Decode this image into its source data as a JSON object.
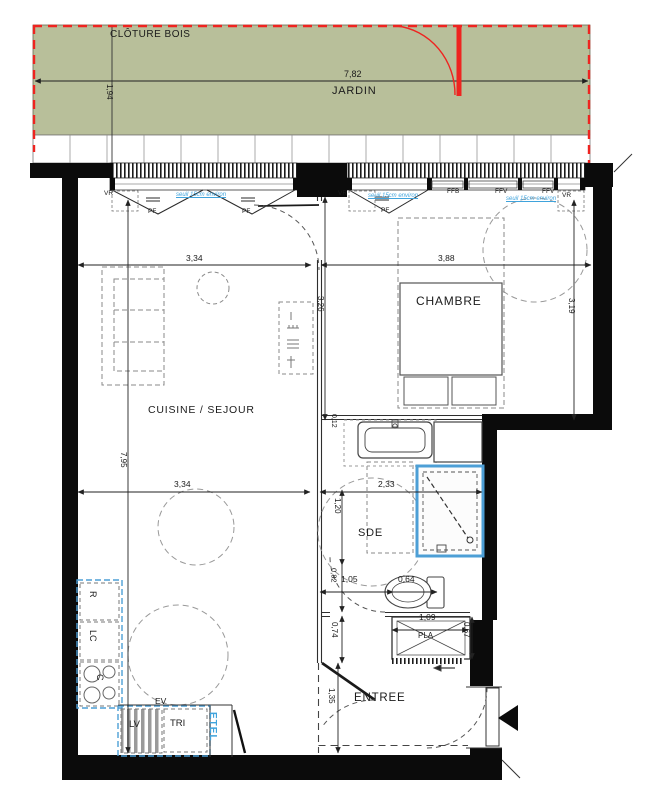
{
  "garden": {
    "fence": "CLÔTURE BOIS",
    "name": "JARDIN",
    "width": "7,82",
    "depth": "1,94"
  },
  "rooms": {
    "kitchen": "CUISINE / SEJOUR",
    "bedroom": "CHAMBRE",
    "bath": "SDE",
    "entry": "ENTREE",
    "closet": "PLA"
  },
  "dims": {
    "kitchen_w": "3,34",
    "bedroom_w": "3,88",
    "bedroom_h_left": "3,26",
    "bedroom_h_right": "3,19",
    "kitchen_h": "7,95",
    "kitchen_w2": "3,34",
    "bath_w": "2,33",
    "bath_h": "1,20",
    "wall_t": "0,12",
    "wc_l": "1,05",
    "wc_w": "0,64",
    "wc_h": "0,82",
    "pla_h_left": "0,74",
    "pla_w": "1,09",
    "pla_h_right": "0,67",
    "entry_h": "1,35"
  },
  "windows": {
    "vr": "VR",
    "pf": "PF",
    "ffb": "FFB",
    "ffv": "FFV",
    "seuil_note": "seuil 15cm environ"
  },
  "appliances": {
    "fridge": "R",
    "washer": "LC",
    "hob": "C",
    "dishwasher": "LV",
    "sorting": "TRI",
    "sink": "EV",
    "etel": "ETEL"
  },
  "colors": {
    "garden": "#b8bf9a",
    "fence": "#ee2420",
    "note_blue": "#3fa3dc",
    "fixture_blue": "#4d9fd6",
    "wall": "#0b0b0b"
  }
}
